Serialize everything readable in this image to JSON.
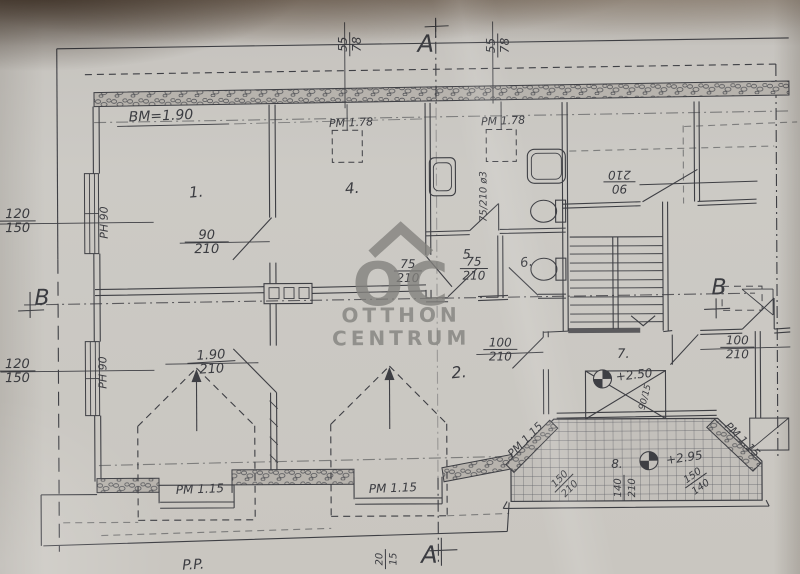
{
  "watermark": {
    "monogram": "OC",
    "line1": "OTTHON",
    "line2": "CENTRUM"
  },
  "colors": {
    "paper": "#cac7c2",
    "ink": "#3b3c41",
    "wall_fill": "#b7b3ad",
    "watermark_gray": "#82817d",
    "photo_shadow_brown": "#5c4430"
  },
  "labels": [
    {
      "id": "dim-55-78-left",
      "num": "55",
      "den": "78",
      "x": 351,
      "y": 44,
      "rot": -90,
      "size": 12,
      "fw": 12
    },
    {
      "id": "section-marker-a-top",
      "text": "A",
      "x": 427,
      "y": 52,
      "size": 24
    },
    {
      "id": "dim-55-78-right",
      "num": "55",
      "den": "78",
      "x": 499,
      "y": 46,
      "rot": -90,
      "size": 12,
      "fw": 12
    },
    {
      "id": "label-bm-height",
      "text": "BM=1.90",
      "x": 162,
      "y": 119,
      "size": 14,
      "rot": -2
    },
    {
      "id": "label-pm-closet-left",
      "text": "PM 1.78",
      "x": 352,
      "y": 126,
      "size": 11,
      "rot": -2
    },
    {
      "id": "label-pm-closet-right",
      "text": "PM 1.78",
      "x": 504,
      "y": 125,
      "size": 11,
      "rot": -2
    },
    {
      "id": "room-label-1",
      "text": "1.",
      "x": 197,
      "y": 196,
      "size": 15,
      "rot": -4
    },
    {
      "id": "room-label-4",
      "text": "4.",
      "x": 353,
      "y": 193,
      "size": 15,
      "rot": -4
    },
    {
      "id": "dim-120-150-upper",
      "num": "120",
      "den": "150",
      "x": 18,
      "y": 219,
      "size": 13,
      "fw": 18
    },
    {
      "id": "dim-ph90-upper",
      "text": "PH 90",
      "x": 108,
      "y": 221,
      "rot": -90,
      "size": 11
    },
    {
      "id": "dim-90-210-room1",
      "num": "90",
      "den": "210",
      "x": 207,
      "y": 241,
      "size": 13,
      "fw": 22
    },
    {
      "id": "dim-75-210-vent",
      "text": "75/210 ø3",
      "x": 487,
      "y": 197,
      "rot": -90,
      "size": 10
    },
    {
      "id": "dim-75-210-left",
      "num": "75",
      "den": "210",
      "x": 408,
      "y": 271,
      "size": 12,
      "fw": 14
    },
    {
      "id": "dim-75-210-right",
      "num": "75",
      "den": "210",
      "x": 474,
      "y": 269,
      "size": 12,
      "fw": 14
    },
    {
      "id": "room-label-5",
      "text": "5.",
      "x": 469,
      "y": 259,
      "size": 13
    },
    {
      "id": "room-label-6",
      "text": "6.",
      "x": 527,
      "y": 267,
      "size": 13,
      "rot": -8
    },
    {
      "id": "dim-90-210-stairs",
      "num": "90",
      "den": "210",
      "x": 620,
      "y": 183,
      "rot": 180,
      "size": 12,
      "fw": 16
    },
    {
      "id": "section-marker-b-left",
      "text": "B",
      "x": 42,
      "y": 303,
      "size": 22
    },
    {
      "id": "dim-120-150-lower",
      "num": "120",
      "den": "150",
      "x": 17,
      "y": 369,
      "size": 13,
      "fw": 18
    },
    {
      "id": "dim-ph90-lower",
      "text": "PH 90",
      "x": 106,
      "y": 371,
      "rot": -90,
      "size": 11
    },
    {
      "id": "dim-190-210-room2",
      "num": "1.90",
      "den": "210",
      "x": 211,
      "y": 361,
      "size": 13,
      "fw": 24,
      "rot": -3
    },
    {
      "id": "room-label-2",
      "text": "2.",
      "x": 459,
      "y": 378,
      "size": 16,
      "rot": -5
    },
    {
      "id": "dim-100-210-left",
      "num": "100",
      "den": "210",
      "x": 500,
      "y": 350,
      "size": 12,
      "fw": 17
    },
    {
      "id": "room-label-7",
      "text": "7.",
      "x": 623,
      "y": 359,
      "size": 13
    },
    {
      "id": "dim-100-210-right",
      "num": "100",
      "den": "210",
      "x": 737,
      "y": 349,
      "size": 12,
      "fw": 17
    },
    {
      "id": "section-marker-b-right",
      "text": "B",
      "x": 719,
      "y": 296,
      "size": 22
    },
    {
      "id": "level-marker-7",
      "text": "+2.50",
      "x": 634,
      "y": 380,
      "size": 12,
      "rot": -6
    },
    {
      "id": "level-marker-7-sub",
      "text": "90/15",
      "x": 647,
      "y": 399,
      "size": 9,
      "rot": -75
    },
    {
      "id": "room-label-8",
      "text": "8.",
      "x": 616,
      "y": 469,
      "size": 12
    },
    {
      "id": "dim-140-210-terrace",
      "num": "140",
      "den": "210",
      "x": 623,
      "y": 489,
      "rot": -90,
      "size": 10,
      "fw": 13
    },
    {
      "id": "level-marker-8",
      "text": "+2.95",
      "x": 684,
      "y": 463,
      "size": 12,
      "rot": -8
    },
    {
      "id": "dim-150-210-terrace-left",
      "num": "150",
      "den": "210",
      "x": 563,
      "y": 484,
      "rot": -45,
      "size": 10,
      "fw": 13
    },
    {
      "id": "dim-150-140-terrace-right",
      "num": "150",
      "den": "140",
      "x": 695,
      "y": 482,
      "rot": -35,
      "size": 10,
      "fw": 13
    },
    {
      "id": "label-pm115-terrace-left",
      "text": "PM 1.15",
      "x": 527,
      "y": 443,
      "rot": -45,
      "size": 11
    },
    {
      "id": "label-pm115-terrace-right",
      "text": "PM 1.15",
      "x": 739,
      "y": 444,
      "rot": 45,
      "size": 11
    },
    {
      "id": "label-pm115-bottom-left",
      "text": "PM 1.15",
      "x": 199,
      "y": 492,
      "size": 12,
      "rot": -2
    },
    {
      "id": "label-pm115-bottom-right",
      "text": "PM 1.15",
      "x": 392,
      "y": 492,
      "size": 12,
      "rot": -2
    },
    {
      "id": "label-pp",
      "text": "P.P.",
      "x": 192,
      "y": 568,
      "size": 14,
      "rot": -3
    },
    {
      "id": "dim-20-15",
      "num": "20",
      "den": "15",
      "x": 384,
      "y": 559,
      "rot": -90,
      "size": 10,
      "fw": 10
    },
    {
      "id": "section-marker-a-bottom",
      "text": "A",
      "x": 428,
      "y": 563,
      "size": 24
    }
  ]
}
